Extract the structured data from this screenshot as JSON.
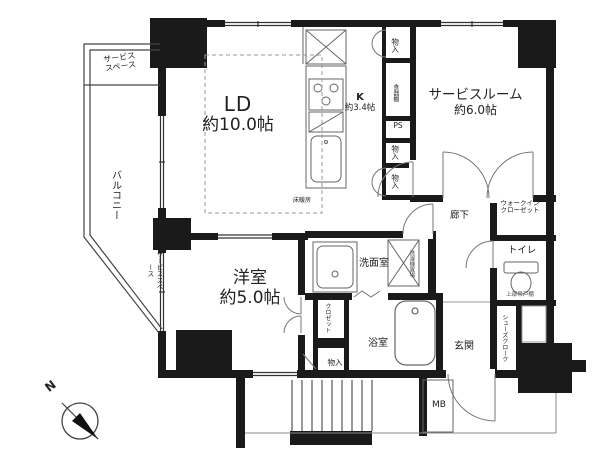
{
  "colors": {
    "wall": "#1a1a1a",
    "line": "#666666",
    "text": "#222222",
    "background": "#ffffff"
  },
  "rooms": {
    "ld": {
      "name": "LD",
      "size": "約10.0帖"
    },
    "kitchen": {
      "name": "K",
      "size": "約3.4帖"
    },
    "service_room": {
      "name": "サービスルーム",
      "size": "約6.0帖"
    },
    "western_room": {
      "name": "洋室",
      "size": "約5.0帖"
    },
    "corridor": {
      "name": "廊下"
    },
    "washroom": {
      "name": "洗面室"
    },
    "bathroom": {
      "name": "浴室"
    },
    "entrance": {
      "name": "玄関"
    },
    "toilet": {
      "name": "トイレ"
    },
    "walk_in_closet": {
      "line1": "ウォークイン",
      "line2": "クローゼット"
    },
    "balcony": {
      "name": "バルコニー"
    },
    "service_space_top": {
      "line1": "サービス",
      "line2": "スペース"
    },
    "service_space_side": {
      "name": "サービススペース"
    },
    "shoes_closet": {
      "name": "シューズクローク"
    },
    "bedroom_closet": {
      "name": "クロゼット"
    }
  },
  "features": {
    "floor_heating": "床暖房",
    "upper_shelf": "上部吊戸棚",
    "washer_space": "洗濯機置場",
    "pipe_space": "PS",
    "dish_shelf": "食器棚",
    "storage_a": "物入",
    "storage_b": "物入",
    "storage_c": "物入",
    "storage_d": "物入",
    "meter_box": "MB",
    "compass_north": "N"
  }
}
